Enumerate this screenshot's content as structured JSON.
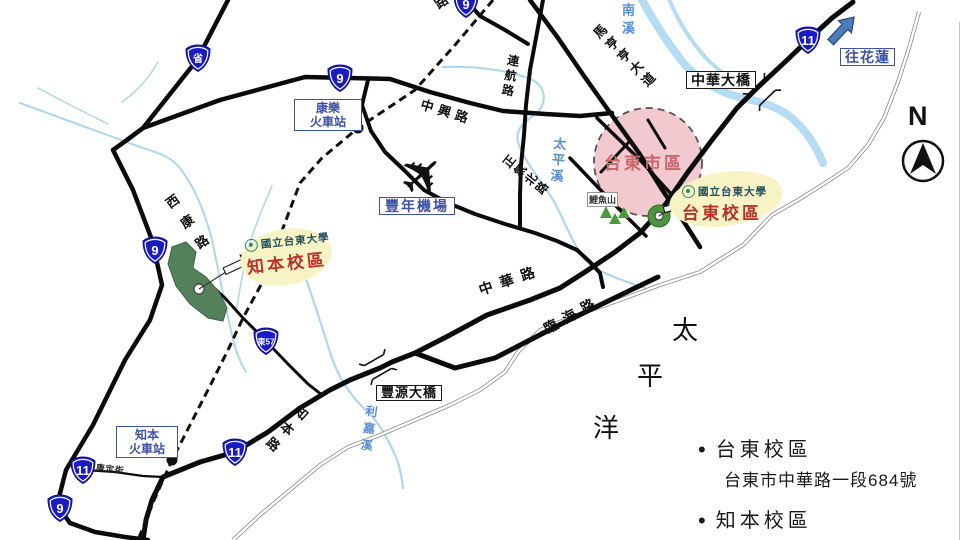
{
  "compass": {
    "n": "N"
  },
  "icons": {
    "airplane": "✈",
    "bullet": "•"
  },
  "shields": {
    "sheng": "省",
    "r9": "9",
    "r11": "11",
    "e57": "東57"
  },
  "places": {
    "kangle_l1": "康樂",
    "kangle_l2": "火車站",
    "zhiben_l1": "知本",
    "zhiben_l2": "火車站",
    "airport": "豐年機場",
    "zhonghua_bridge": "中華大橋",
    "fengyuan_bridge": "豐源大橋",
    "to_hualien": "往花蓮",
    "liyu_mountain": "鯉魚山"
  },
  "areas": {
    "taitung_city": "台東市區",
    "pacific": [
      "太",
      "平",
      "洋"
    ]
  },
  "roads": {
    "zhongxing": "中興路",
    "lianhang": "連航路",
    "zhengqi": "正氣北路",
    "mahenghen": "馬亨亨大道",
    "zhonghua": "中華路",
    "linhai": "臨海路",
    "xikang": "西康路",
    "zhiben": "知本路",
    "kangding": "康定街",
    "partial_top": "路"
  },
  "rivers": {
    "beinan": "南溪",
    "taiping": "太平溪",
    "lijia": "利嘉溪"
  },
  "campuses": {
    "university_name": "國立台東大學",
    "taitung": "台東校區",
    "zhiben": "知本校區"
  },
  "legend": {
    "items": [
      {
        "title": "台東校區",
        "address": "台東市中華路一段684號"
      },
      {
        "title": "知本校區"
      }
    ]
  }
}
